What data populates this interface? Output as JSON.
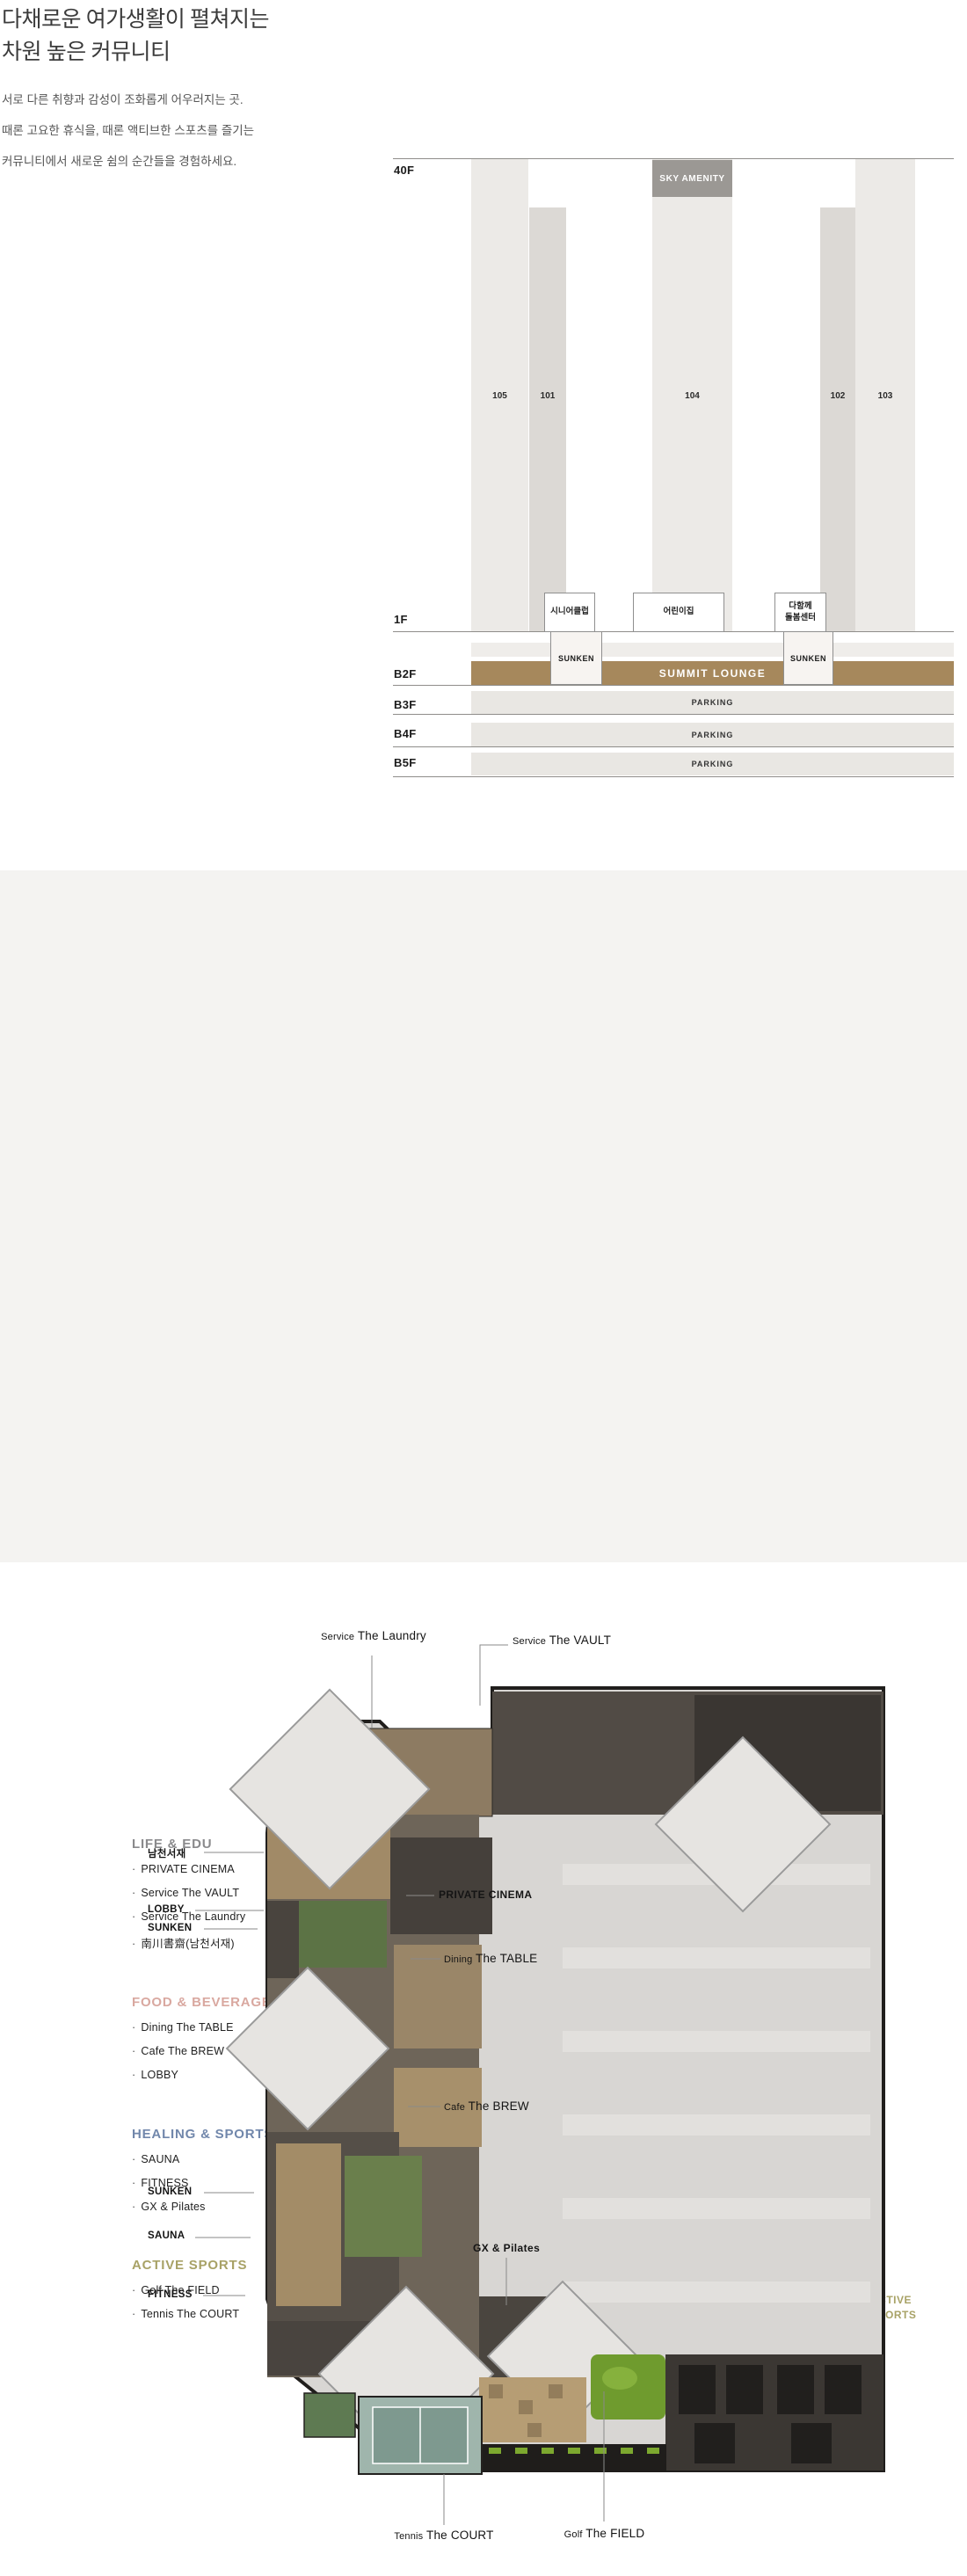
{
  "intro": {
    "title": [
      "다채로운 여가생활이 펼쳐지는",
      "차원 높은 커뮤니티"
    ],
    "desc": [
      "서로 다른 취향과 감성이 조화롭게 어우러지는 곳.",
      "때론 고요한 휴식을, 때론 액티브한 스포츠를 즐기는",
      "커뮤니티에서 새로운 쉼의 순간들을 경험하세요."
    ]
  },
  "elevation": {
    "floor_labels": {
      "f40": "40F",
      "f1": "1F",
      "b2": "B2F",
      "b3": "B3F",
      "b4": "B4F",
      "b5": "B5F"
    },
    "sky_amenity": "SKY AMENITY",
    "towers": {
      "t105": "105",
      "t101": "101",
      "t104": "104",
      "t102": "102",
      "t103": "103"
    },
    "boxes": {
      "senior": "시니어클럽",
      "kids": "어린이집",
      "care_line1": "다함께",
      "care_line2": "돌봄센터"
    },
    "sunken": "SUNKEN",
    "summit": "SUMMIT LOUNGE",
    "parking": "PARKING"
  },
  "siteplan": {
    "bullet": "·",
    "compass": "N",
    "legend": [
      {
        "title": "LIFE & EDU",
        "items": [
          "PRIVATE CINEMA",
          "Service The VAULT",
          "Service The Laundry",
          "南川書齋(남천서재)"
        ]
      },
      {
        "title": "FOOD & BEVERAGE",
        "items": [
          "Dining The TABLE",
          "Cafe The BREW",
          "LOBBY"
        ]
      },
      {
        "title": "HEALING & SPORTS",
        "items": [
          "SAUNA",
          "FITNESS",
          "GX & Pilates"
        ]
      },
      {
        "title": "ACTIVE SPORTS",
        "items": [
          "Golf The FIELD",
          "Tennis The COURT"
        ]
      }
    ],
    "zone_labels": {
      "life": "LIFE & EDU",
      "food1": "FOOD &",
      "food2": "BEVERAGE",
      "heal1": "HEALING &",
      "heal2": "SPORTS",
      "active1": "ACTIVE",
      "active2": "SPORTS"
    },
    "badges": {
      "b105": "105",
      "b101": "101",
      "b104": "104",
      "b103": "103",
      "b102": "102"
    },
    "sunken": "SUNKEN",
    "colors": {
      "life": "#8A8A8C",
      "food": "#D9A8A0",
      "healing": "#7187AB",
      "active": "#A8A266",
      "zone_pink": "#E8C9C3",
      "zone_blue": "#B0BDD7",
      "zone_olive": "#C7C4A0",
      "building_gray": "#ADA7A5",
      "badge_black": "#161616",
      "summit_brown": "#A6885C"
    }
  },
  "floorplan": {
    "labels": {
      "laundry": {
        "prefix": "Service",
        "name": "The Laundry"
      },
      "vault": {
        "prefix": "Service",
        "name": "The VAULT"
      },
      "seojae": {
        "name": "남천서재"
      },
      "lobby": {
        "name": "LOBBY"
      },
      "sunken_top": {
        "name": "SUNKEN"
      },
      "cinema": {
        "name": "PRIVATE CINEMA"
      },
      "table": {
        "prefix": "Dining",
        "name": "The TABLE"
      },
      "brew": {
        "prefix": "Cafe",
        "name": "The BREW"
      },
      "sunken_bottom": {
        "name": "SUNKEN"
      },
      "sauna": {
        "name": "SAUNA"
      },
      "fitness": {
        "name": "FITNESS"
      },
      "gx": {
        "name": "GX & Pilates"
      },
      "tennis": {
        "prefix": "Tennis",
        "name": "The COURT"
      },
      "golf": {
        "prefix": "Golf",
        "name": "The FIELD"
      }
    }
  }
}
